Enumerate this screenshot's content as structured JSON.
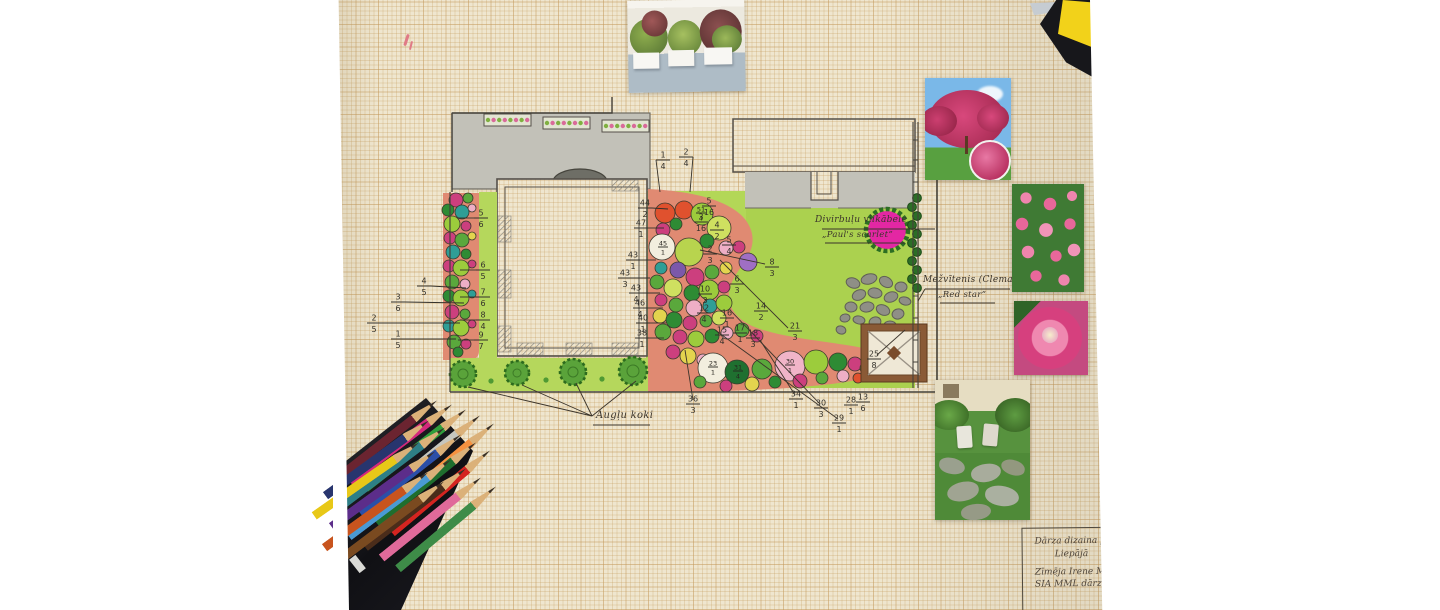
{
  "labels": {
    "hawthorn_name": "Divirbuļu vilkābele",
    "hawthorn_cultivar": "„Paul's scarlet”",
    "clematis_name": "Mežvītenis (Clematis)",
    "clematis_cultivar": "„Red star”",
    "fruit_trees": "Augļu koki",
    "title_block": {
      "line1": "Dārza dizaina plā",
      "line2": "Liepājā",
      "line3": "Zīmēja Irene Mude",
      "line4": "SIA MML dārzi. 19"
    }
  },
  "annotations": {
    "fractions": [
      {
        "v": "4/5",
        "x": 424,
        "y": 286,
        "lx": 466,
        "ly": 288
      },
      {
        "v": "3/6",
        "x": 398,
        "y": 302,
        "lx": 464,
        "ly": 303
      },
      {
        "v": "2/5",
        "x": 374,
        "y": 323,
        "lx": 460,
        "ly": 323
      },
      {
        "v": "1/5",
        "x": 398,
        "y": 339,
        "lx": 456,
        "ly": 339
      },
      {
        "v": "5/6",
        "x": 481,
        "y": 218,
        "lx": 458,
        "ly": 218
      },
      {
        "v": "6/5",
        "x": 483,
        "y": 270,
        "lx": 460,
        "ly": 270
      },
      {
        "v": "7/6",
        "x": 483,
        "y": 297,
        "lx": 460,
        "ly": 297
      },
      {
        "v": "8/4",
        "x": 483,
        "y": 320,
        "lx": 460,
        "ly": 320
      },
      {
        "v": "9/7",
        "x": 481,
        "y": 340,
        "lx": 458,
        "ly": 340
      },
      {
        "v": "1/4",
        "x": 663,
        "y": 160,
        "lx": 660,
        "ly": 192
      },
      {
        "v": "2/4",
        "x": 686,
        "y": 157,
        "lx": 690,
        "ly": 192
      },
      {
        "v": "44/2",
        "x": 645,
        "y": 208,
        "lx": 668,
        "ly": 209
      },
      {
        "v": "47/1",
        "x": 641,
        "y": 228,
        "lx": 664,
        "ly": 228
      },
      {
        "v": "43/1",
        "x": 633,
        "y": 260,
        "lx": 656,
        "ly": 260
      },
      {
        "v": "43/3",
        "x": 625,
        "y": 278,
        "lx": 650,
        "ly": 278
      },
      {
        "v": "43/4",
        "x": 636,
        "y": 293,
        "lx": 660,
        "ly": 293
      },
      {
        "v": "46/4",
        "x": 640,
        "y": 308,
        "lx": 663,
        "ly": 308
      },
      {
        "v": "40/1",
        "x": 643,
        "y": 323,
        "lx": 666,
        "ly": 323
      },
      {
        "v": "38/1",
        "x": 642,
        "y": 338,
        "lx": 664,
        "ly": 338
      },
      {
        "v": "5/16",
        "x": 709,
        "y": 206
      },
      {
        "v": "3/16",
        "x": 701,
        "y": 222
      },
      {
        "v": "4/2",
        "x": 717,
        "y": 230
      },
      {
        "v": "5/4",
        "x": 729,
        "y": 245
      },
      {
        "v": "2/3",
        "x": 710,
        "y": 254
      },
      {
        "v": "8/3",
        "x": 772,
        "y": 267
      },
      {
        "v": "6/3",
        "x": 737,
        "y": 284
      },
      {
        "v": "10/3",
        "x": 705,
        "y": 294
      },
      {
        "v": "12/4",
        "x": 704,
        "y": 313
      },
      {
        "v": "16/1",
        "x": 727,
        "y": 318
      },
      {
        "v": "14/2",
        "x": 761,
        "y": 311
      },
      {
        "v": "15/4",
        "x": 722,
        "y": 335
      },
      {
        "v": "17/1",
        "x": 740,
        "y": 333
      },
      {
        "v": "18/3",
        "x": 753,
        "y": 338
      },
      {
        "v": "21/3",
        "x": 795,
        "y": 331
      },
      {
        "v": "36/3",
        "x": 693,
        "y": 404
      },
      {
        "v": "34/1",
        "x": 796,
        "y": 399
      },
      {
        "v": "30/3",
        "x": 821,
        "y": 408
      },
      {
        "v": "29/1",
        "x": 839,
        "y": 423
      },
      {
        "v": "28/1",
        "x": 851,
        "y": 405
      },
      {
        "v": "13/6",
        "x": 863,
        "y": 402
      },
      {
        "v": "25/8",
        "x": 874,
        "y": 359
      }
    ],
    "circle_labels": [
      {
        "v": "45/1",
        "x": 663,
        "y": 247
      },
      {
        "v": "51/4",
        "x": 701,
        "y": 213
      },
      {
        "v": "23/1",
        "x": 713,
        "y": 367
      },
      {
        "v": "31/4",
        "x": 738,
        "y": 371
      },
      {
        "v": "30/1",
        "x": 790,
        "y": 365
      }
    ]
  },
  "plan": {
    "palette": {
      "or": "#e0512e",
      "yg": "#9ccc3c",
      "cg": "#cfe060",
      "mg": "#cc3f7e",
      "dg": "#2e8b34",
      "wh": "#f2eede",
      "y2": "#b8d44e",
      "pk": "#eeaec6",
      "pu": "#9f6fc4",
      "p2": "#7b58aa",
      "gr": "#5aa83c",
      "yl": "#e3d44e",
      "tl": "#2f9e96",
      "d2": "#1f7030",
      "k2": "#f0b4c8"
    },
    "central_bed_circles": [
      [
        665,
        213,
        10,
        "or"
      ],
      [
        684,
        210,
        9,
        "or"
      ],
      [
        702,
        214,
        11,
        "yg"
      ],
      [
        719,
        228,
        12,
        "cg"
      ],
      [
        663,
        230,
        7,
        "mg"
      ],
      [
        676,
        224,
        6,
        "dg"
      ],
      [
        662,
        247,
        13,
        "wh"
      ],
      [
        689,
        252,
        14,
        "y2"
      ],
      [
        707,
        241,
        7,
        "dg"
      ],
      [
        726,
        248,
        7,
        "pk"
      ],
      [
        739,
        247,
        6,
        "mg"
      ],
      [
        748,
        262,
        9,
        "pu"
      ],
      [
        678,
        270,
        8,
        "p2"
      ],
      [
        695,
        277,
        9,
        "mg"
      ],
      [
        712,
        272,
        7,
        "gr"
      ],
      [
        726,
        268,
        6,
        "yl"
      ],
      [
        661,
        268,
        6,
        "tl"
      ],
      [
        657,
        282,
        7,
        "gr"
      ],
      [
        673,
        288,
        9,
        "cg"
      ],
      [
        692,
        293,
        8,
        "dg"
      ],
      [
        709,
        290,
        10,
        "yg"
      ],
      [
        724,
        287,
        6,
        "mg"
      ],
      [
        661,
        300,
        6,
        "mg"
      ],
      [
        676,
        305,
        7,
        "gr"
      ],
      [
        694,
        308,
        8,
        "pk"
      ],
      [
        710,
        306,
        7,
        "tl"
      ],
      [
        724,
        303,
        8,
        "yg"
      ],
      [
        660,
        316,
        7,
        "yl"
      ],
      [
        674,
        320,
        8,
        "dg"
      ],
      [
        690,
        323,
        7,
        "mg"
      ],
      [
        706,
        321,
        6,
        "gr"
      ],
      [
        719,
        318,
        7,
        "cg"
      ],
      [
        663,
        332,
        8,
        "gr"
      ],
      [
        680,
        337,
        7,
        "mg"
      ],
      [
        696,
        339,
        8,
        "yg"
      ],
      [
        712,
        336,
        7,
        "dg"
      ],
      [
        727,
        333,
        6,
        "pk"
      ],
      [
        742,
        330,
        7,
        "gr"
      ],
      [
        757,
        336,
        6,
        "mg"
      ]
    ],
    "bottom_row_circles": [
      [
        673,
        352,
        7,
        "mg"
      ],
      [
        688,
        356,
        8,
        "yl"
      ],
      [
        703,
        360,
        6,
        "pk"
      ],
      [
        713,
        368,
        15,
        "wh"
      ],
      [
        737,
        372,
        12,
        "d2"
      ],
      [
        762,
        369,
        10,
        "gr"
      ],
      [
        790,
        366,
        15,
        "k2"
      ],
      [
        816,
        362,
        12,
        "yg"
      ],
      [
        838,
        362,
        9,
        "dg"
      ],
      [
        855,
        364,
        7,
        "mg"
      ],
      [
        866,
        368,
        6,
        "gr"
      ],
      [
        700,
        382,
        6,
        "gr"
      ],
      [
        726,
        386,
        6,
        "mg"
      ],
      [
        752,
        384,
        7,
        "yl"
      ],
      [
        775,
        382,
        6,
        "dg"
      ],
      [
        800,
        381,
        7,
        "mg"
      ],
      [
        822,
        378,
        6,
        "gr"
      ],
      [
        843,
        376,
        6,
        "pk"
      ],
      [
        858,
        378,
        5,
        "or"
      ]
    ],
    "left_bed_circles": [
      [
        456,
        200,
        7,
        "mg"
      ],
      [
        468,
        198,
        5,
        "gr"
      ],
      [
        448,
        210,
        6,
        "dg"
      ],
      [
        462,
        212,
        7,
        "tl"
      ],
      [
        472,
        208,
        4,
        "pk"
      ],
      [
        452,
        224,
        8,
        "yg"
      ],
      [
        466,
        226,
        5,
        "mg"
      ],
      [
        450,
        238,
        6,
        "mg"
      ],
      [
        462,
        240,
        7,
        "gr"
      ],
      [
        472,
        236,
        4,
        "yl"
      ],
      [
        453,
        252,
        7,
        "tl"
      ],
      [
        466,
        254,
        5,
        "dg"
      ],
      [
        449,
        266,
        6,
        "mg"
      ],
      [
        461,
        268,
        8,
        "yg"
      ],
      [
        472,
        264,
        4,
        "mg"
      ],
      [
        452,
        282,
        7,
        "gr"
      ],
      [
        465,
        284,
        5,
        "pk"
      ],
      [
        449,
        296,
        6,
        "dg"
      ],
      [
        461,
        298,
        8,
        "yg"
      ],
      [
        472,
        294,
        4,
        "tl"
      ],
      [
        452,
        312,
        7,
        "mg"
      ],
      [
        465,
        314,
        5,
        "gr"
      ],
      [
        449,
        326,
        6,
        "tl"
      ],
      [
        461,
        328,
        8,
        "yg"
      ],
      [
        472,
        324,
        4,
        "mg"
      ],
      [
        454,
        342,
        7,
        "gr"
      ],
      [
        466,
        344,
        5,
        "mg"
      ],
      [
        458,
        352,
        5,
        "dg"
      ]
    ],
    "stones": [
      [
        853,
        283,
        7,
        5,
        20
      ],
      [
        869,
        279,
        8,
        5,
        -15
      ],
      [
        886,
        282,
        7,
        5,
        30
      ],
      [
        901,
        287,
        6,
        5,
        0
      ],
      [
        859,
        295,
        7,
        5,
        -25
      ],
      [
        875,
        293,
        7,
        5,
        10
      ],
      [
        891,
        297,
        7,
        5,
        -20
      ],
      [
        905,
        301,
        6,
        4,
        15
      ],
      [
        851,
        307,
        6,
        5,
        5
      ],
      [
        867,
        307,
        7,
        5,
        -10
      ],
      [
        883,
        310,
        7,
        5,
        25
      ],
      [
        898,
        314,
        6,
        5,
        -15
      ],
      [
        859,
        320,
        6,
        4,
        10
      ],
      [
        875,
        322,
        6,
        5,
        -20
      ],
      [
        890,
        325,
        6,
        4,
        0
      ],
      [
        845,
        318,
        5,
        4,
        -10
      ],
      [
        841,
        330,
        5,
        4,
        20
      ]
    ],
    "bushes": [
      [
        463,
        374,
        13
      ],
      [
        517,
        373,
        12
      ],
      [
        573,
        372,
        13
      ],
      [
        633,
        371,
        14
      ]
    ],
    "bush_dots": [
      [
        491,
        381
      ],
      [
        546,
        380
      ],
      [
        602,
        379
      ]
    ],
    "hawthorn_tree": {
      "cx": 887,
      "cy": 230,
      "r": 19,
      "fill": "#e327a3",
      "ring": "#2c6e22"
    }
  },
  "photos": [
    {
      "name": "white-planter-boxes"
    },
    {
      "name": "pink-hawthorn-tree"
    },
    {
      "name": "pink-clematis-cluster"
    },
    {
      "name": "pink-clematis-single-bloom"
    },
    {
      "name": "garden-patio-with-chairs"
    }
  ],
  "pencils": {
    "case_color": "#17171b",
    "colors": [
      {
        "c": "#6b2430",
        "t": [
          437,
          400
        ],
        "a": -38
      },
      {
        "c": "#d4287c",
        "t": [
          452,
          404
        ],
        "a": -37
      },
      {
        "c": "#2f9e3c",
        "t": [
          466,
          409
        ],
        "a": -38
      },
      {
        "c": "#c6c6be",
        "t": [
          480,
          415
        ],
        "a": -39
      },
      {
        "c": "#f59140",
        "t": [
          494,
          423
        ],
        "a": -40
      },
      {
        "c": "#28356e",
        "t": [
          429,
          420
        ],
        "a": -36
      },
      {
        "c": "#2e7f86",
        "t": [
          445,
          427
        ],
        "a": -37
      },
      {
        "c": "#2b4fa8",
        "t": [
          461,
          434
        ],
        "a": -38
      },
      {
        "c": "#1f6e2e",
        "t": [
          476,
          442
        ],
        "a": -39
      },
      {
        "c": "#d42420",
        "t": [
          490,
          450
        ],
        "a": -40
      },
      {
        "c": "#e8c818",
        "t": [
          419,
          442
        ],
        "a": -35
      },
      {
        "c": "#5c2d8a",
        "t": [
          435,
          451
        ],
        "a": -36
      },
      {
        "c": "#4a9ad4",
        "t": [
          451,
          459
        ],
        "a": -37
      },
      {
        "c": "#4a2c1a",
        "t": [
          466,
          468
        ],
        "a": -38
      },
      {
        "c": "#e06a9a",
        "t": [
          481,
          477
        ],
        "a": -39
      },
      {
        "c": "#3e8c48",
        "t": [
          496,
          486
        ],
        "a": -40
      },
      {
        "c": "#c8541e",
        "t": [
          428,
          472
        ],
        "a": -36
      },
      {
        "c": "#7a4a20",
        "t": [
          444,
          481
        ],
        "a": -37
      }
    ]
  },
  "colors": {
    "paper": "#efe6cf",
    "lawn": "#abd14f",
    "bed": "#e08a72",
    "pencil_grey": "#c2c1b8",
    "sticky_yellow": "#f2d21a",
    "ink": "#3b342b"
  }
}
